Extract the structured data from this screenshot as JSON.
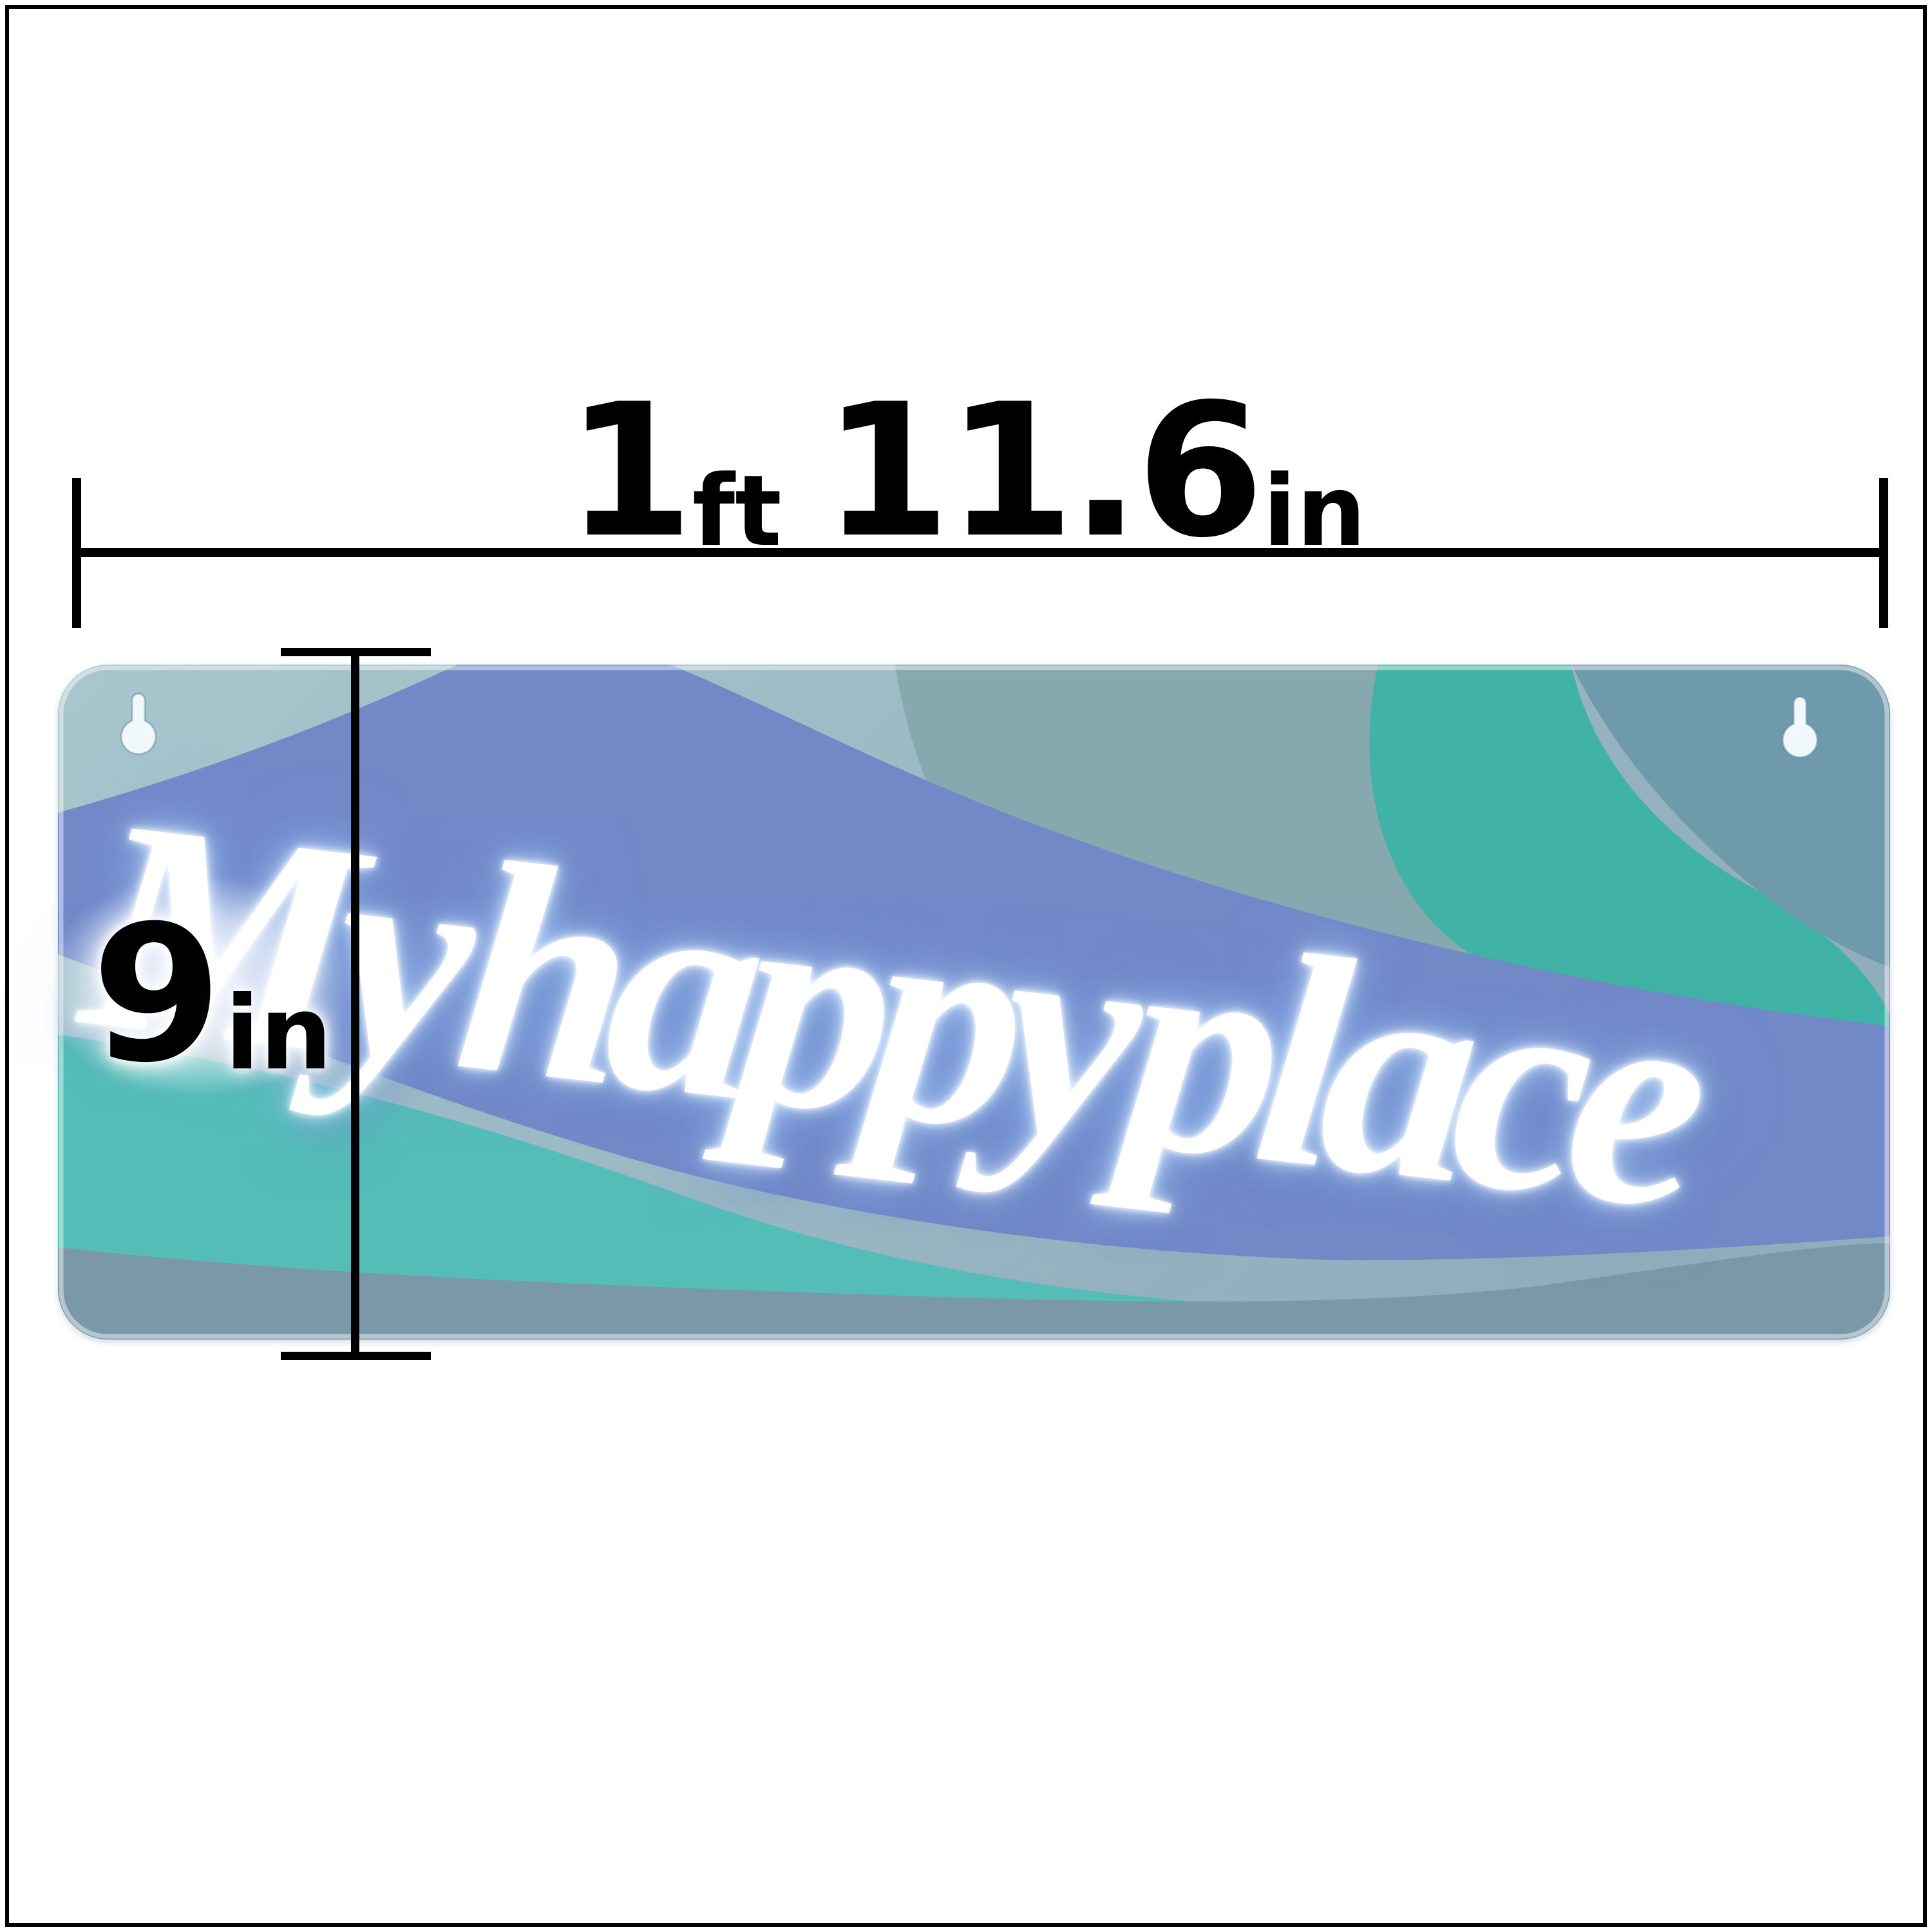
{
  "width_dimension": {
    "feet_value": "1",
    "feet_unit": "ft",
    "inches_value": "11.6",
    "inches_unit": "in"
  },
  "height_dimension": {
    "value": "9",
    "unit": "in"
  },
  "sign": {
    "neon_text": "My happy place",
    "neon_color": "#ffffff",
    "neon_glow_color": "#9cc2f0",
    "band_colors": {
      "base_light": "#a8c6cd",
      "base_dark": "#8fadbb",
      "sage_teal": "#86a9b0",
      "teal_band": "#41b2a6",
      "slate_corner": "#6f9aab",
      "periwinkle": "#7289c8",
      "turquoise": "#54bdb8",
      "bottom_slate": "#7b98a9",
      "keyhole_fill": "#f0f8fb",
      "keyhole_stroke": "#5d8496"
    },
    "annotation_color": "#000000"
  }
}
